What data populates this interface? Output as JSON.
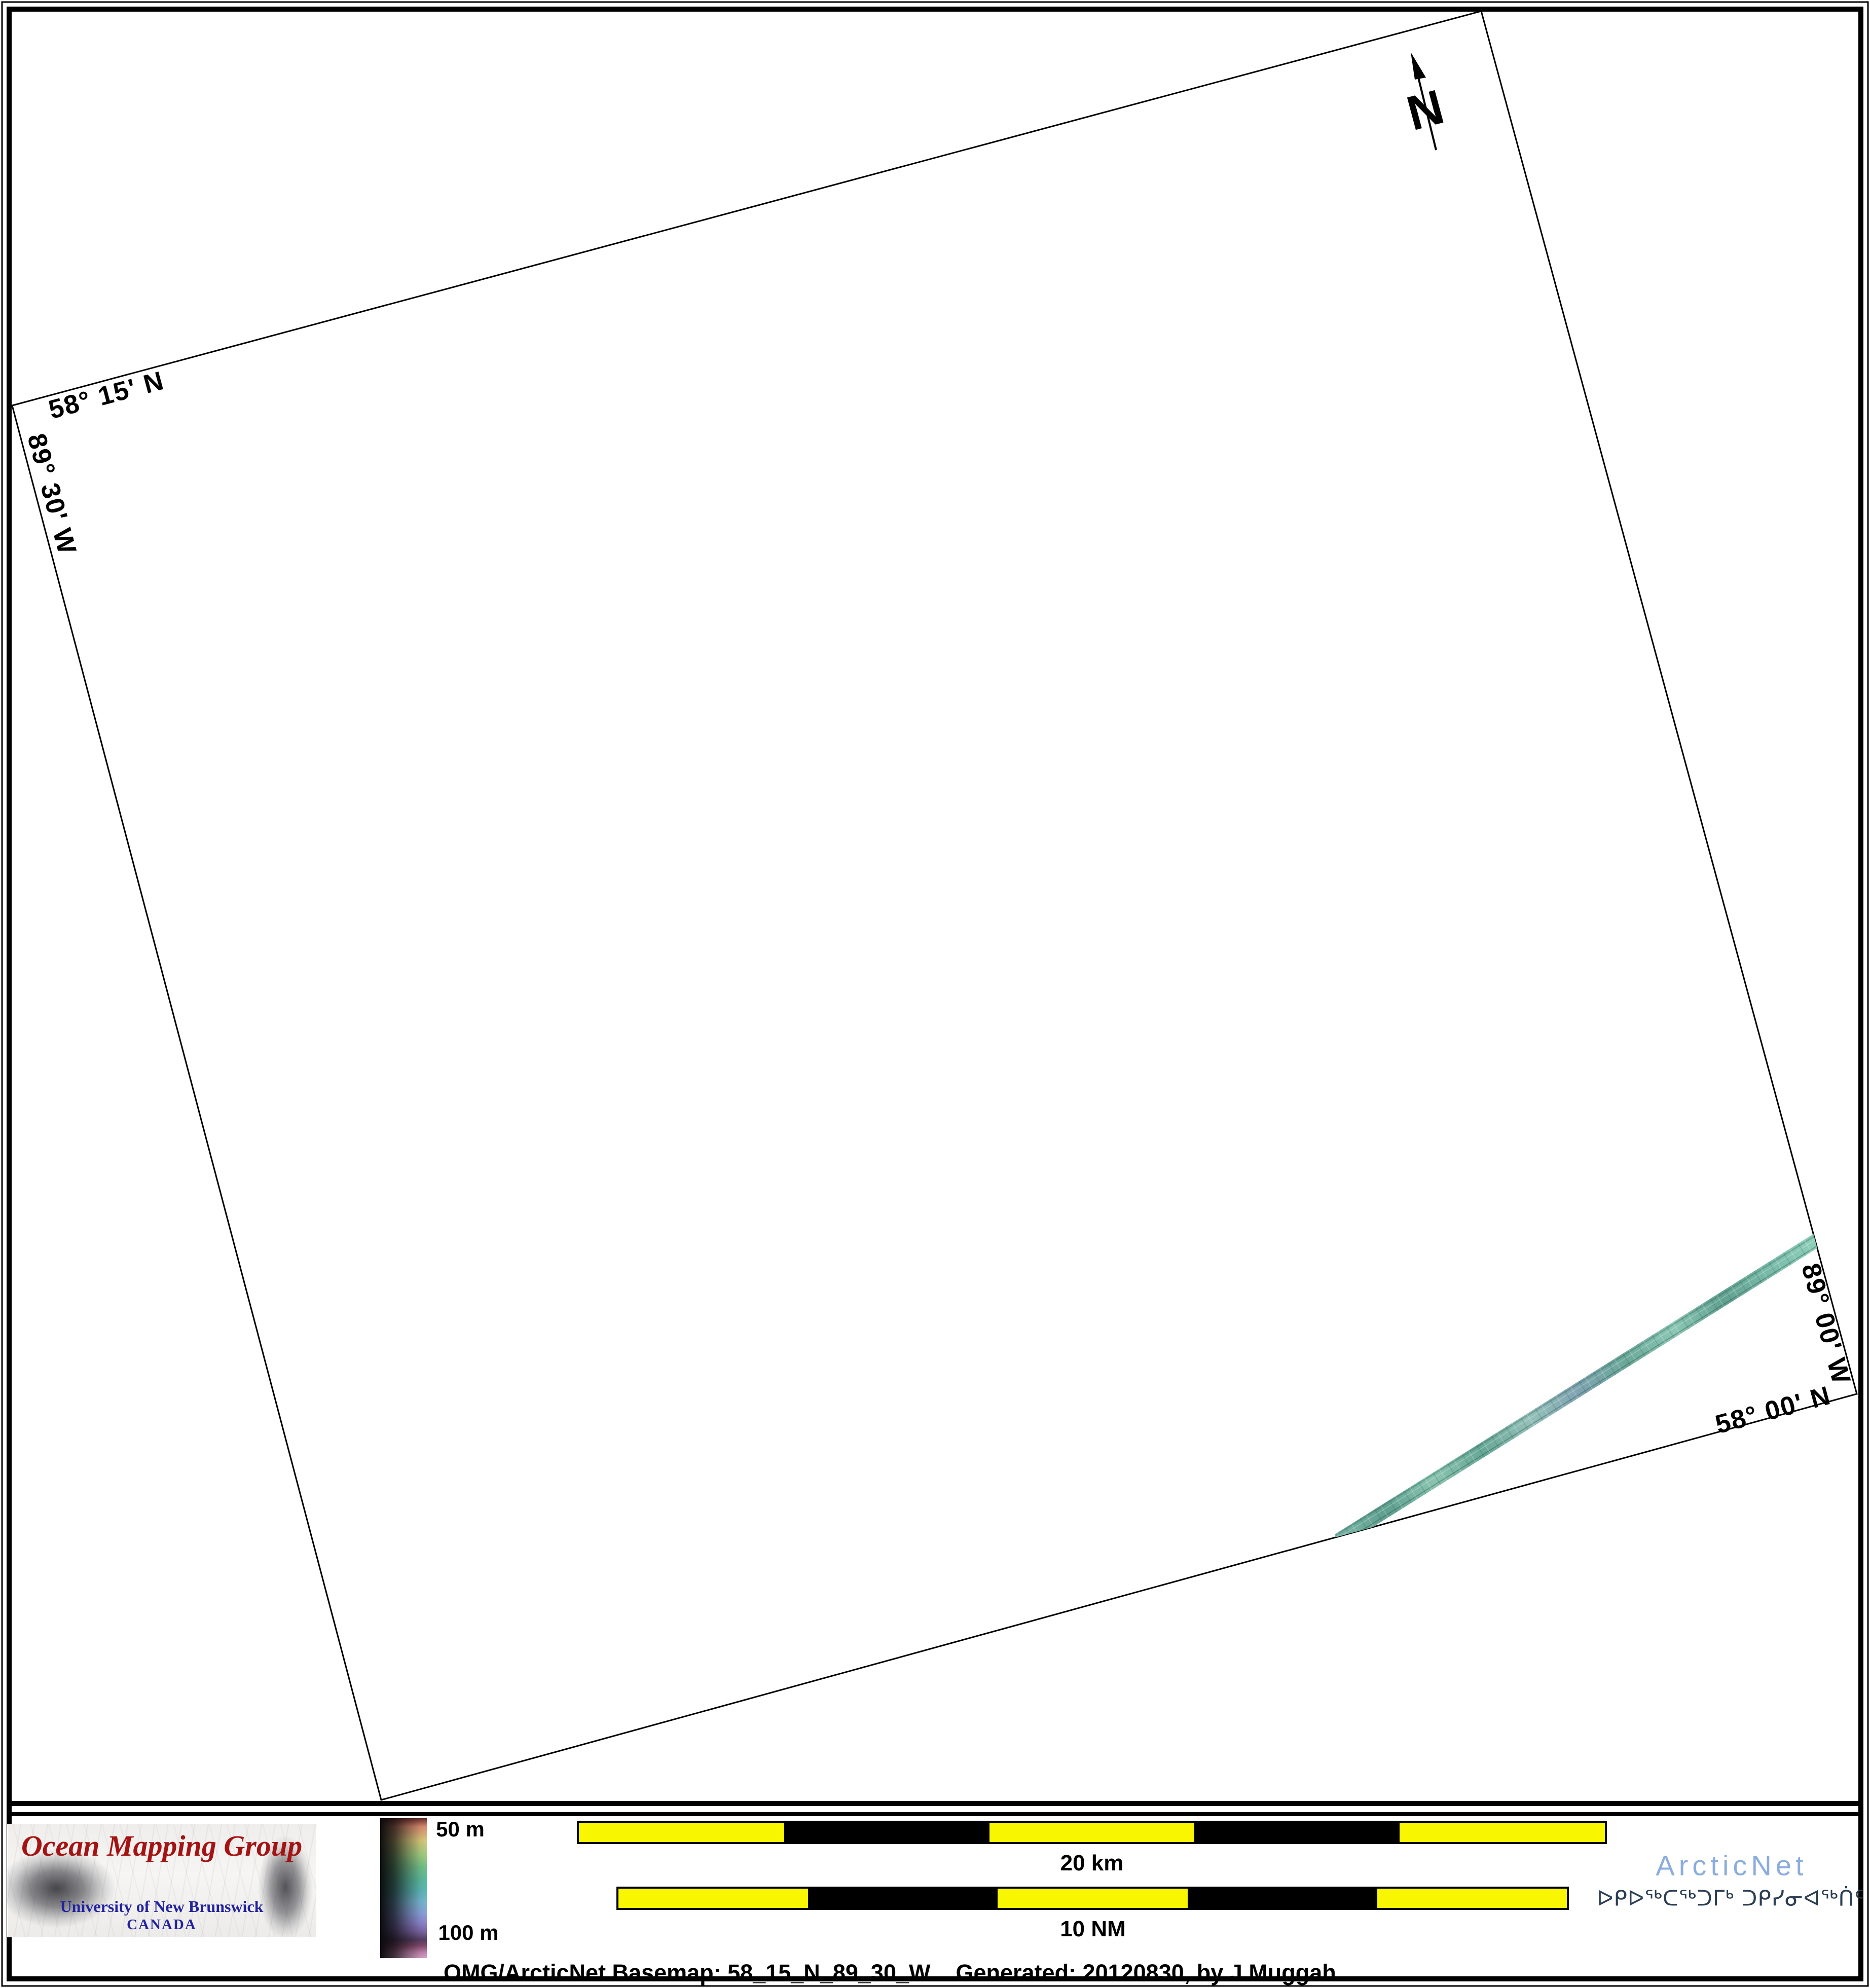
{
  "map": {
    "corner_labels": {
      "top_left_lat": "58° 15' N",
      "left_lon": "89° 30' W",
      "right_lon": "89° 00' W",
      "bottom_lat": "58° 00' N"
    },
    "north_label": "N"
  },
  "legend": {
    "logo": {
      "title": "Ocean Mapping Group",
      "subtitle": "University of New Brunswick",
      "country": "CANADA"
    },
    "colorbar": {
      "top_label": "50 m",
      "bottom_label": "100 m"
    },
    "scalebars": [
      {
        "label": "20 km"
      },
      {
        "label": "10 NM"
      }
    ],
    "arcticnet": {
      "name": "ArcticNet",
      "inuktitut": "ᐅᑭᐅᖅᑕᖅᑐᒥᒃ ᑐᑭᓯᓂᐊᖅᑏᑦ"
    },
    "caption": "OMG/ArcticNet Basemap: 58_15_N_89_30_W    Generated: 20120830, by J.Muggah"
  },
  "colors": {
    "accent_red": "#a41313",
    "unb_blue": "#2323a0",
    "arcticnet_blue": "#8badde",
    "syllabics_navy": "#2c3f54",
    "scalebar_yellow": "#f8f600",
    "swath_teal": "#6fae9e"
  }
}
